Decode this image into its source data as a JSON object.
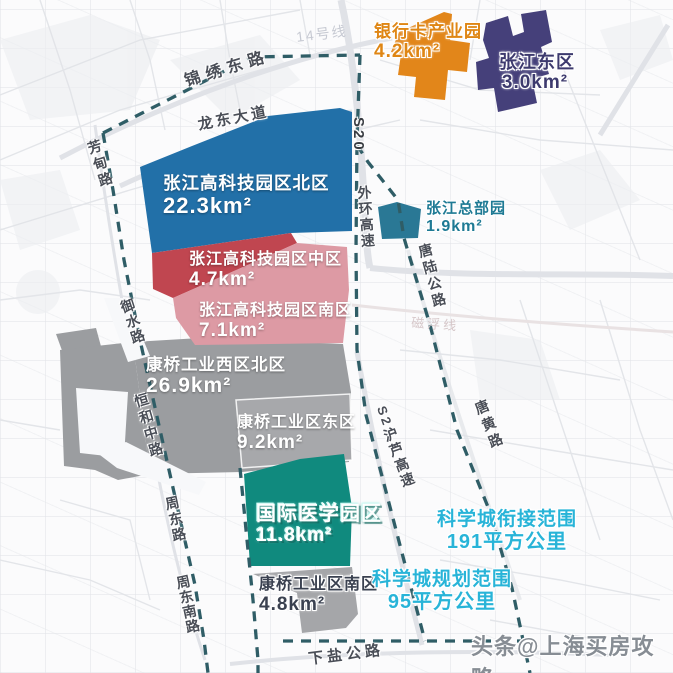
{
  "colors": {
    "boundary_dash": "#2F5D66",
    "cyan_text": "#28B4D8",
    "orange_text": "#DF8614",
    "navy_text": "#3D3A6E",
    "teal_text": "#1E7A94",
    "road_text": "#4A4E57",
    "south_label_text": "#3A4150",
    "watermark_text": "#878D94"
  },
  "regions": [
    {
      "name": "张江高科技园区北区",
      "area": "22.3km²",
      "color": "#2270A8"
    },
    {
      "name": "张江高科技园区中区",
      "area": "4.7km²",
      "color": "#C04650"
    },
    {
      "name": "张江高科技园区南区",
      "area": "7.1km²",
      "color": "#DD9AA4"
    },
    {
      "name": "康桥工业西区北区",
      "area": "26.9km²",
      "color": "#9B9DA0"
    },
    {
      "name": "康桥工业区东区",
      "area": "9.2km²",
      "color": "#A7A8AB"
    },
    {
      "name": "国际医学园区",
      "area": "11.8km²",
      "color": "#108A7E"
    },
    {
      "name": "康桥工业区南区",
      "area": "4.8km²",
      "color": "#A5A6A9"
    },
    {
      "name": "银行卡产业园",
      "area": "4.2km²",
      "color": "#E2861A"
    },
    {
      "name": "张江东区",
      "area": "3.0km²",
      "color": "#45407A"
    },
    {
      "name": "张江总部园",
      "area": "1.9km²",
      "color": "#2A7895"
    }
  ],
  "boundary_ranges": [
    {
      "name": "科学城衔接范围",
      "area": "191平方公里"
    },
    {
      "name": "科学城规划范围",
      "area": "95平方公里"
    }
  ],
  "roads": [
    {
      "label": "锦绣东路"
    },
    {
      "label": "龙东大道"
    },
    {
      "label": "芳甸路"
    },
    {
      "label": "S20"
    },
    {
      "label": "外环高速"
    },
    {
      "label": "唐陆公路"
    },
    {
      "label": "唐黄路"
    },
    {
      "label": "御水路"
    },
    {
      "label": "恒和中路"
    },
    {
      "label": "周东路"
    },
    {
      "label": "周东南路"
    },
    {
      "label": "S2"
    },
    {
      "label": "沪芦高速"
    },
    {
      "label": "下盐公路"
    },
    {
      "label": "14号线"
    },
    {
      "label": "磁浮线"
    }
  ],
  "watermark": {
    "text": "头条@上海买房攻略"
  }
}
